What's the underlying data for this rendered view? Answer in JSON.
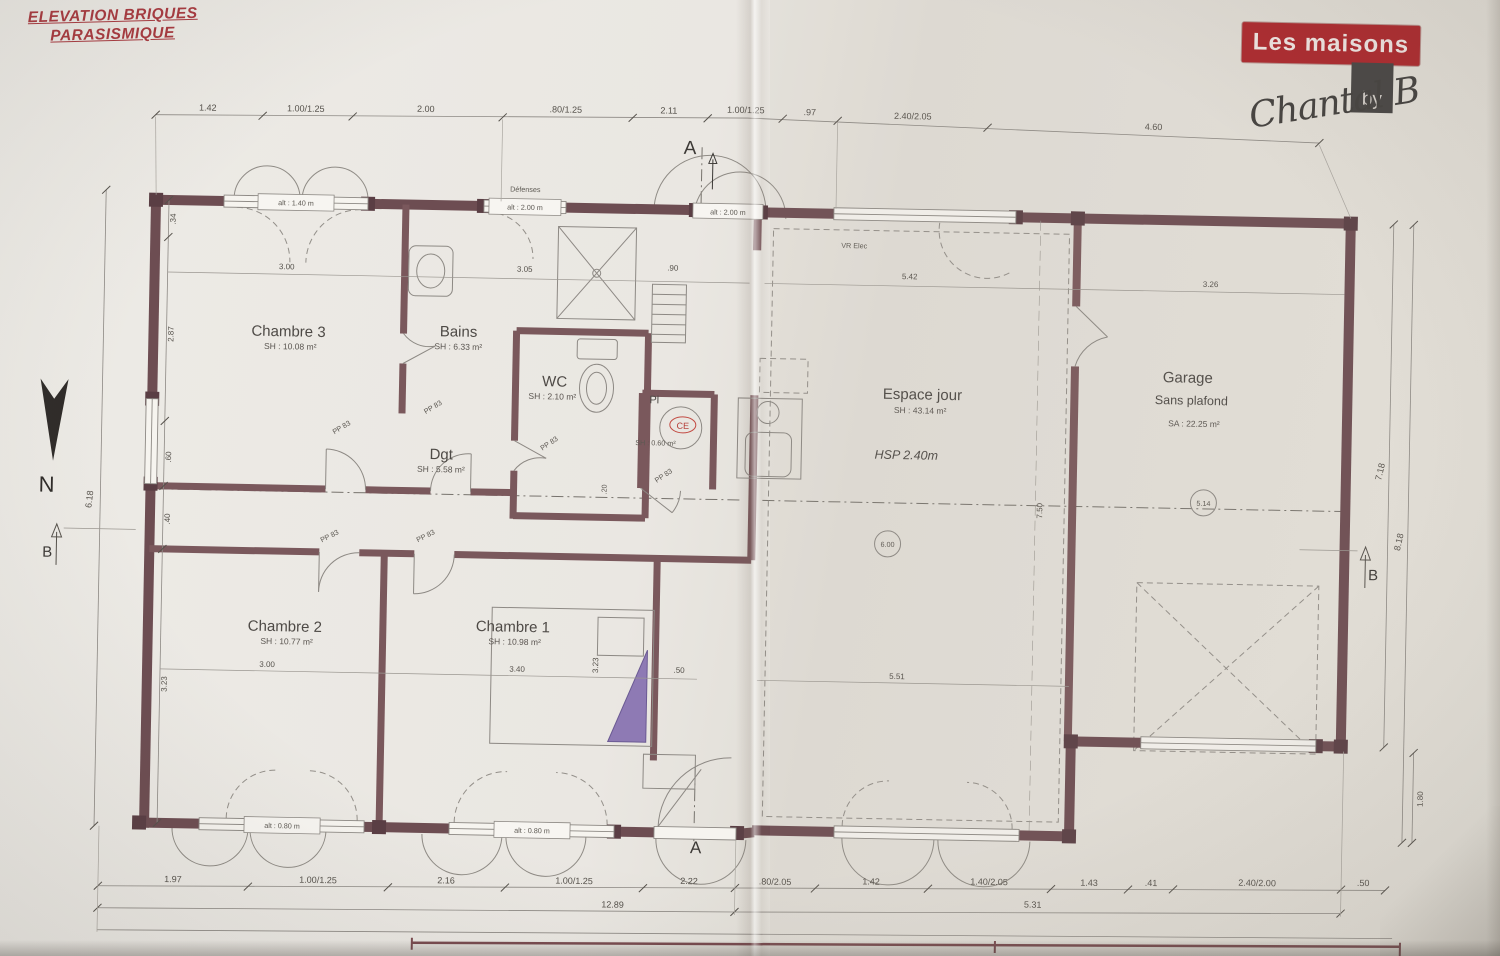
{
  "page": {
    "note_line1": "ELEVATION BRIQUES",
    "note_line2": "PARASISMIQUE",
    "brand": "Les maisons",
    "brand_by": "by",
    "signature": "Chantal B"
  },
  "markers": {
    "north": "N",
    "a": "A",
    "b": "B"
  },
  "rooms": {
    "chambre3": {
      "name": "Chambre 3",
      "area": "SH : 10.08 m²"
    },
    "bains": {
      "name": "Bains",
      "area": "SH : 6.33 m²"
    },
    "wc": {
      "name": "WC",
      "area": "SH : 2.10 m²"
    },
    "dgt": {
      "name": "Dgt",
      "area": "SH : 5.58 m²"
    },
    "pl": {
      "name": "Pl",
      "area": "SH : 0.60 m²",
      "ce": "CE"
    },
    "chambre2": {
      "name": "Chambre 2",
      "area": "SH : 10.77 m²"
    },
    "chambre1": {
      "name": "Chambre 1",
      "area": "SH : 10.98 m²"
    },
    "espace_jour": {
      "name": "Espace jour",
      "area": "SH : 43.14 m²",
      "hsp": "HSP 2.40m"
    },
    "garage": {
      "name": "Garage",
      "subtitle": "Sans plafond",
      "area": "SA : 22.25 m²"
    }
  },
  "annotations": {
    "door_label": "PP 83",
    "vr_elec": "VR Elec",
    "defenses": "Défenses",
    "alt_140": "alt : 1.40 m",
    "alt_200": "alt : 2.00 m",
    "alt_080": "alt : 0.80 m",
    "bubble_living": "6.00",
    "bubble_garage": "5.14"
  },
  "dims": {
    "top": [
      "1.42",
      "1.00/1.25",
      "2.00",
      ".80/1.25",
      "2.11",
      "1.00/1.25",
      ".97",
      "2.40/2.05",
      "4.60"
    ],
    "bottom": [
      "1.97",
      "1.00/1.25",
      "2.16",
      "1.00/1.25",
      "2.22",
      ".80/2.05",
      "1.42",
      "1.40/2.05",
      "1.43",
      ".41",
      "2.40/2.00",
      ".50"
    ],
    "bottom_total_left": "12.89",
    "bottom_total_right": "5.31",
    "left_outer": "6.18",
    "left_chain": [
      ".34",
      "2.87",
      ".60",
      ".40",
      "3.23"
    ],
    "right_chain": [
      "7.18",
      "8.18",
      "1.80"
    ],
    "interior": {
      "ch3_w": "3.00",
      "bains_w": "3.05",
      "wc_w": ".90",
      "ej_w": "5.42",
      "gar_w": "3.26",
      "ch2_w": "3.00",
      "ch1_w": "3.40",
      "ch1_h": "3.23",
      "hall": ".50",
      "ej_bottom": "5.51",
      "ej_h": "7.50",
      "corridor": ".20"
    }
  }
}
